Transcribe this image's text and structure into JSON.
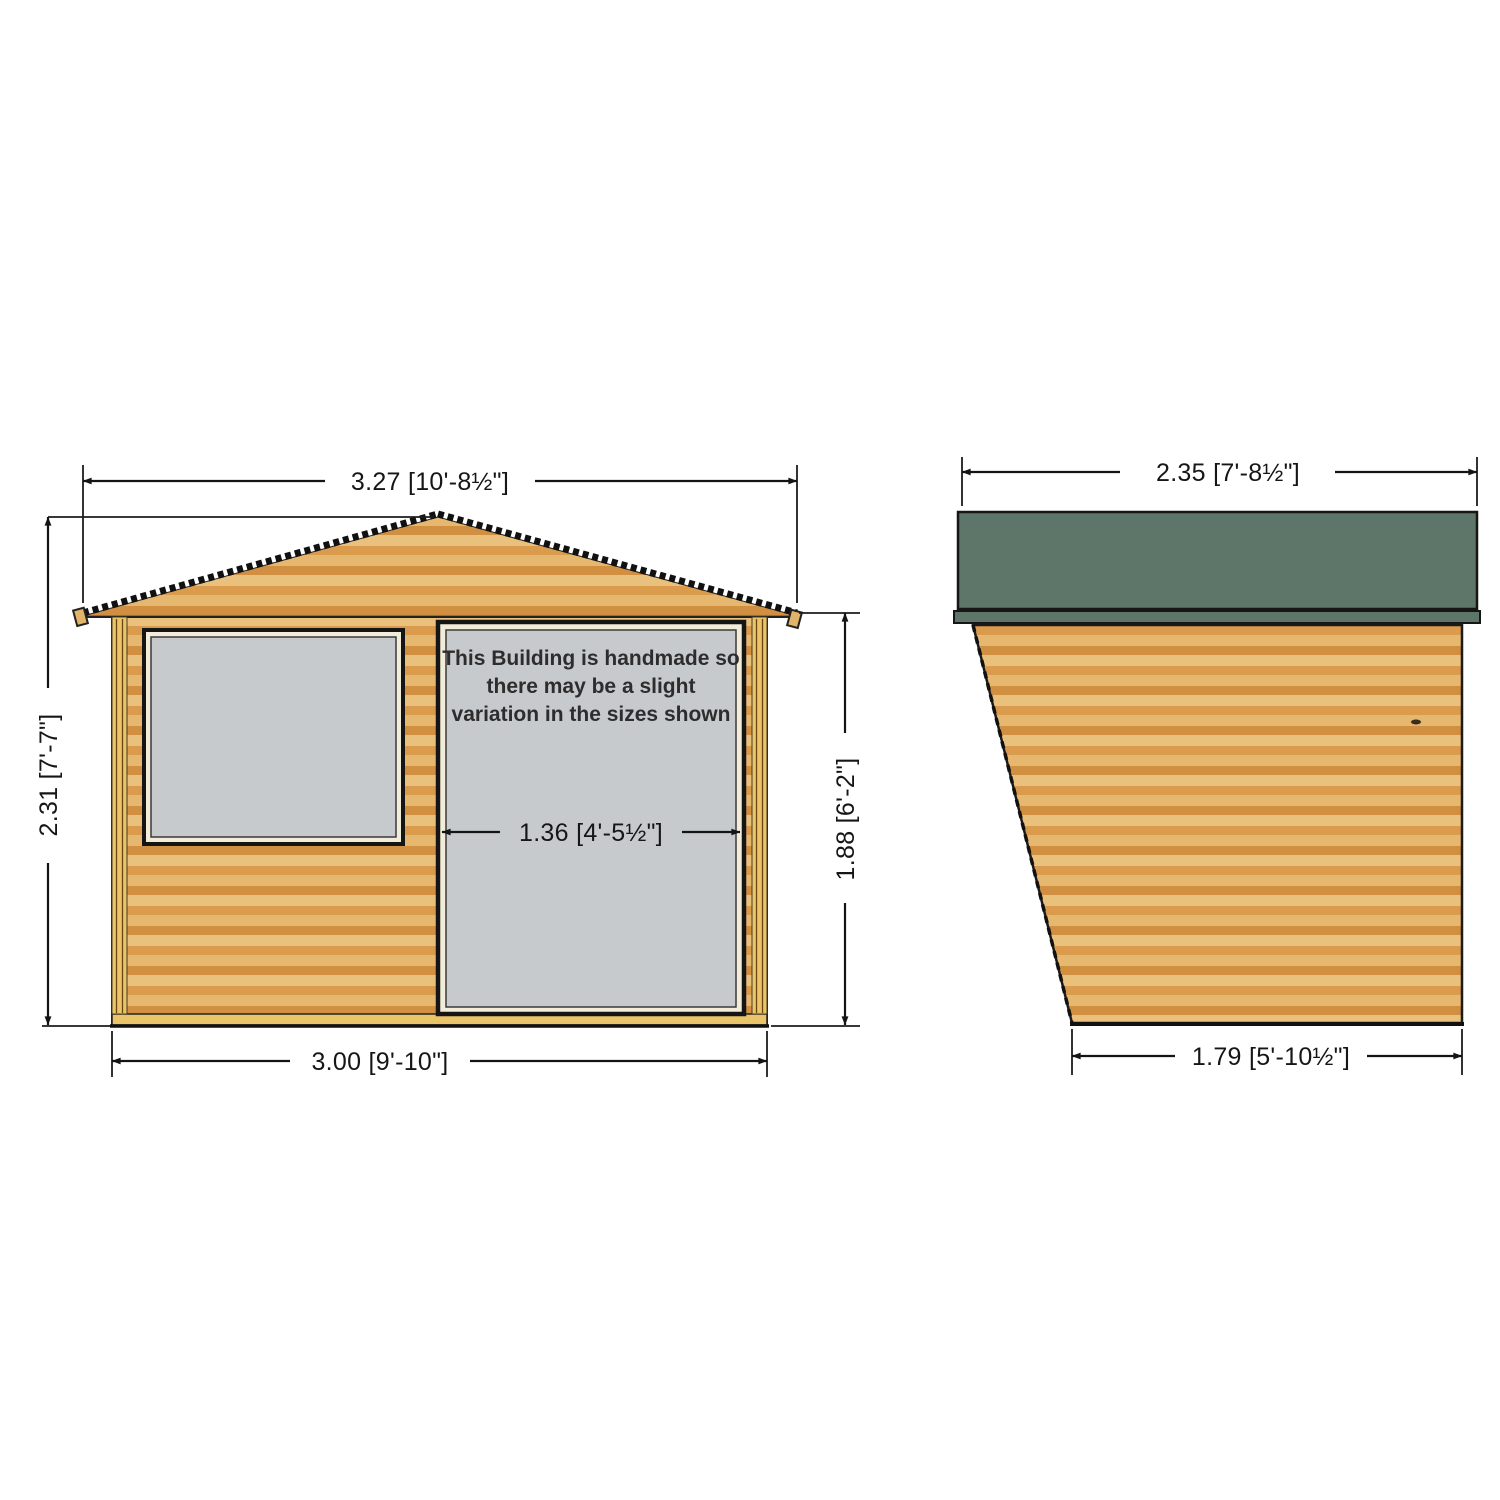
{
  "drawing": {
    "type": "shed-technical-drawing",
    "front_view": {
      "note": {
        "line1": "This Building is handmade so",
        "line2": "there may be a slight",
        "line3": "variation in the sizes shown"
      },
      "dimensions": {
        "roof_width": "3.27 [10'-8½\"]",
        "overall_height": "2.31 [7'-7\"]",
        "eaves_height": "1.88 [6'-2\"]",
        "base_width": "3.00 [9'-10\"]",
        "door_width": "1.36 [4'-5½\"]"
      }
    },
    "side_view": {
      "dimensions": {
        "roof_depth": "2.35 [7'-8½\"]",
        "base_depth": "1.79 [5'-10½\"]"
      }
    },
    "colors": {
      "wood_light": "#e9c17d",
      "wood_dark": "#d89a4a",
      "trim_gold": "#e9c468",
      "glass_gray": "#c7cacd",
      "roof_green": "#5d7669",
      "frame_cream": "#f3ecd9",
      "line_black": "#141414"
    }
  }
}
